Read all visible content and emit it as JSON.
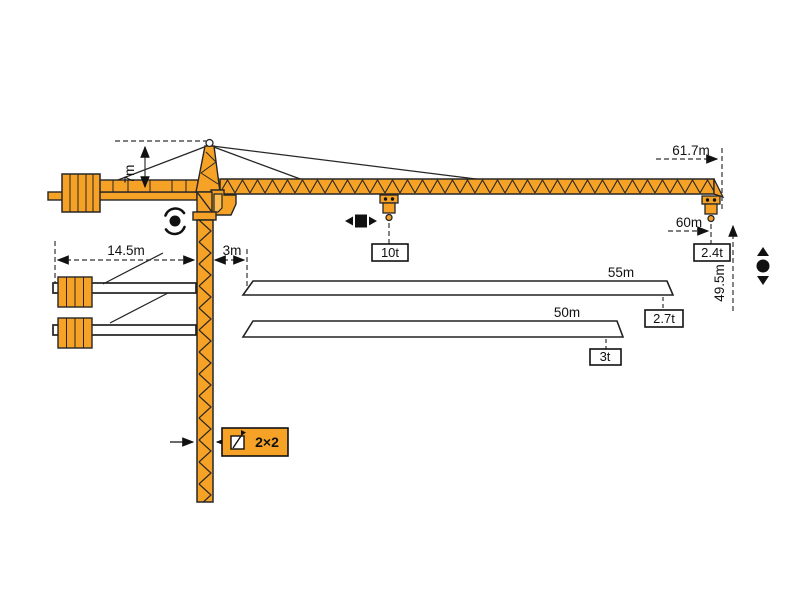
{
  "diagram": {
    "type": "tower-crane-dimension-and-load-diagram",
    "labels": {
      "head_height": "7m",
      "counterjib_length": "14.5m",
      "rear_offset": "3m",
      "max_radius": "61.7m",
      "hook_radius": "60m",
      "max_load": "10t",
      "tip_load_617": "2.4t",
      "jib_55": "55m",
      "tip_load_55": "2.7t",
      "jib_50": "50m",
      "tip_load_50": "3t",
      "hook_height": "49.5m",
      "mast_section": "2×2"
    },
    "load_chart": [
      {
        "jib_length": "61.7m",
        "tip_load": "2.4t"
      },
      {
        "jib_length": "55m",
        "tip_load": "2.7t"
      },
      {
        "jib_length": "50m",
        "tip_load": "3t"
      }
    ],
    "max_load_at_trolley": "10t",
    "icons": {
      "slew_symbol": "rotation-arrows-around-dot",
      "trolley_symbol": "left-right-arrows-square",
      "hoist_symbol": "up-down-arrows-dot",
      "mast_section_symbol": "square-cross-section"
    },
    "colors": {
      "crane_orange": "#F6A227",
      "window_orange": "#FBBF55",
      "outline": "#262626",
      "dimension": "#333333"
    }
  }
}
